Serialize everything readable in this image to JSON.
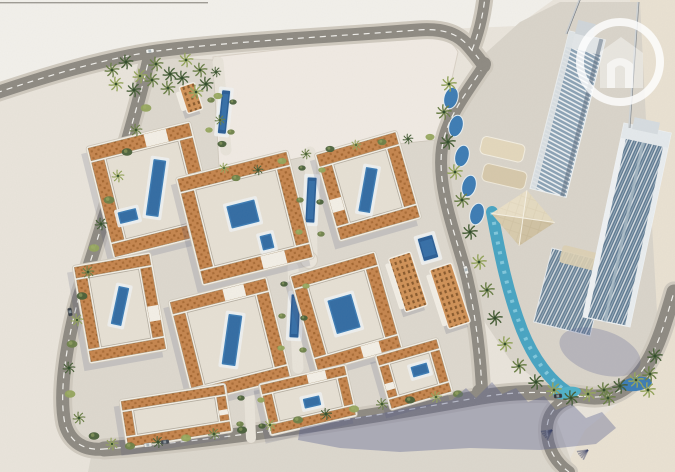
{
  "scene": {
    "type": "aerial-3d-masterplan-rendering",
    "districts": [
      "courtyard-residential-district",
      "vacant-parcel",
      "highrise-tower-district"
    ],
    "vehicle_count": 6
  },
  "watermark": {
    "icon": "circle-house-logo",
    "glyph": "house-n-monogram",
    "ring_color": "rgba(255,255,255,0.8)"
  },
  "palette": {
    "sand": "#e9e4db",
    "sand_warm": "#e9e1d2",
    "paper": "#f2f0eb",
    "pavement": "#ddd8ce",
    "parcel": "#f0eae3",
    "road": "#8e8a82",
    "dash": "#f7f6f1",
    "sidewalk": "#cfc9be",
    "roof": "#c5854e",
    "roof_dark": "#a2652f",
    "facade": "#f3efe6",
    "facade_shade": "#bdb6a9",
    "court": "#e6e0d4",
    "pool": "#3d7cb4",
    "pool_deep": "#2b5e95",
    "pool_light": "#7db2d6",
    "river": "#48a4c2",
    "green": "#6b7f47",
    "green_dark": "#485f38",
    "green_light": "#94a45c",
    "glass": "#8ba2b5",
    "glass_dark": "#5d7890",
    "tower_white": "#edf0f2",
    "podium": "#dbcfb2",
    "orange_win": "#cf9157",
    "shadow": "rgba(90,97,145,0.38)",
    "watermark": "rgba(255,255,255,0.8)"
  }
}
